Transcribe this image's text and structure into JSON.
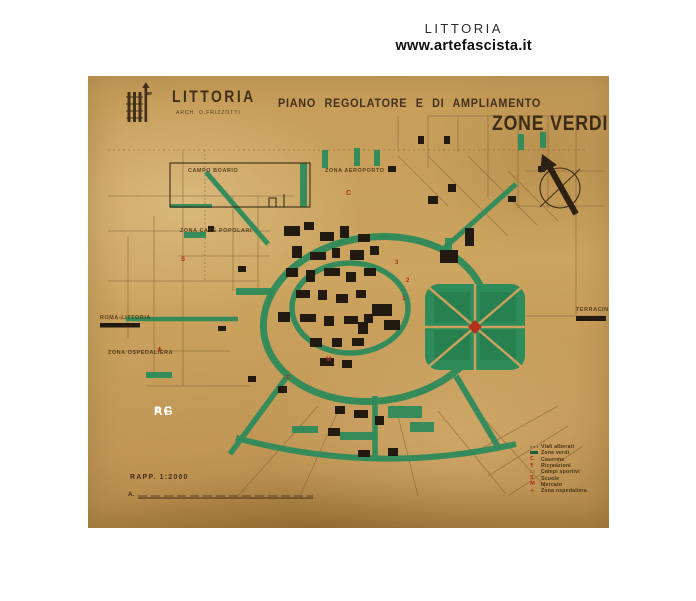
{
  "header": {
    "site_title": "LITTORIA",
    "site_url": "www.artefascista.it"
  },
  "map": {
    "emblem": {
      "line1": "A",
      "line2": "XII",
      "line3": "EF"
    },
    "title": "LITTORIA",
    "architect": "ARCH. O.FRIZZOTTI",
    "subtitle": "PIANO REGOLATORE E DI AMPLIAMENTO",
    "zone_title": "ZONE VERDI",
    "labels": [
      {
        "text": "CAMPO BOARIO"
      },
      {
        "text": "ZONA AEROPORTO"
      },
      {
        "text": "ZONA CASE POPOLARI"
      },
      {
        "text": "ROMA-LITTORIA"
      },
      {
        "text": "ZONA OSPEDALIERA"
      },
      {
        "text": "TERRACINA"
      }
    ],
    "markers": [
      {
        "text": "C"
      },
      {
        "text": "S"
      },
      {
        "text": "3"
      },
      {
        "text": "2"
      },
      {
        "text": "1"
      },
      {
        "text": "+"
      },
      {
        "text": "M"
      },
      {
        "text": "C"
      }
    ],
    "watermark": {
      "line1": "PG",
      "line2": "AF"
    },
    "scale": {
      "label": "RAPP.  1:2000",
      "bar_prefix": "A."
    },
    "legend": {
      "items": [
        {
          "glyph": "···",
          "label": "Viali alberati"
        },
        {
          "glyph": "",
          "label": "Zone verdi"
        },
        {
          "glyph": "C",
          "label": "Caserme"
        },
        {
          "glyph": "¶",
          "label": "Ricreazioni"
        },
        {
          "glyph": "▭",
          "label": "Campi sportivi"
        },
        {
          "glyph": "S",
          "label": "Scuole"
        },
        {
          "glyph": "M",
          "label": "Mercato"
        },
        {
          "glyph": "+",
          "label": "Zona ospedaliera"
        }
      ]
    }
  },
  "colors": {
    "paper": "#c69d5a",
    "green": "#2e8b5a",
    "red": "#b5301c",
    "ink": "#43301a"
  }
}
